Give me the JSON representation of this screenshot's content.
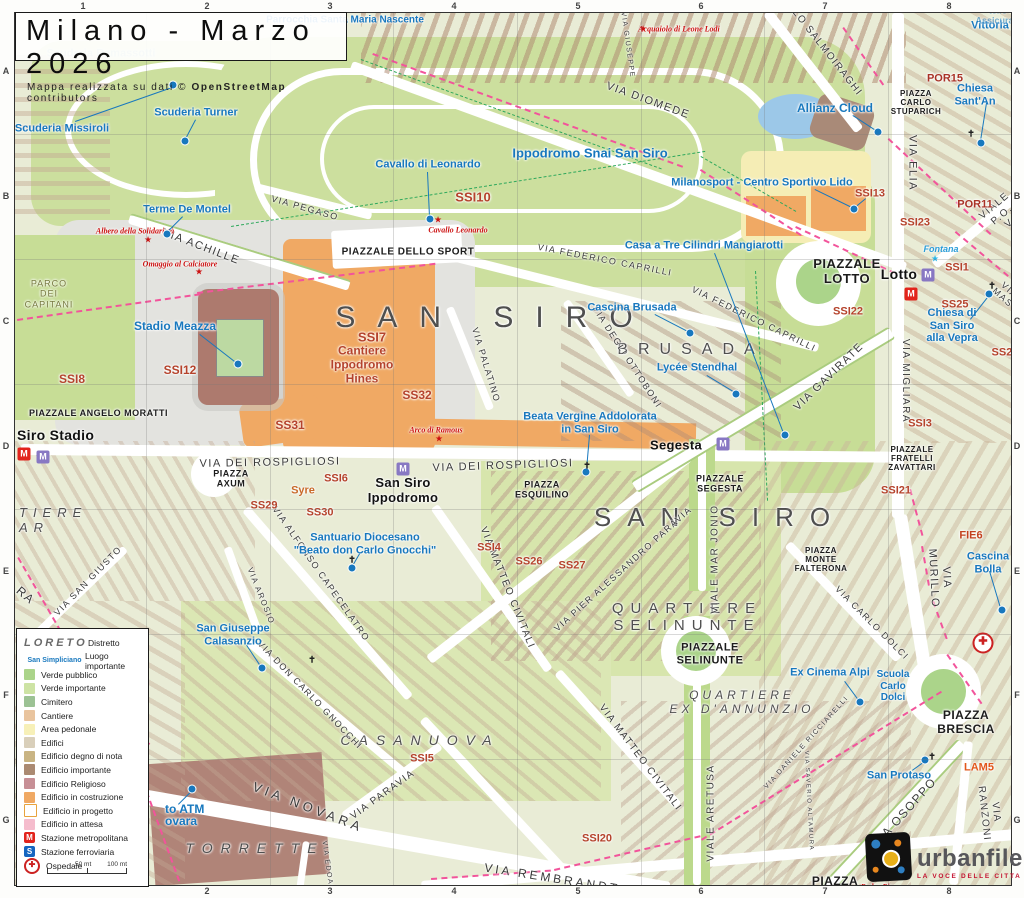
{
  "title": {
    "text": "Milano - Marzo 2026",
    "subtitle_prefix": "Mappa realizzata su dati © ",
    "subtitle_bold": "OpenStreetMap",
    "subtitle_suffix": " contributors"
  },
  "grid": {
    "cols": [
      "1",
      "2",
      "3",
      "4",
      "5",
      "6",
      "7",
      "8"
    ],
    "rows": [
      "A",
      "B",
      "C",
      "D",
      "E",
      "F",
      "G"
    ],
    "col_x": [
      83,
      207,
      330,
      454,
      578,
      701,
      825,
      949
    ],
    "row_y": [
      71,
      196,
      321,
      446,
      571,
      695,
      820
    ],
    "vlines_x": [
      145,
      269,
      392,
      516,
      640,
      763,
      887
    ],
    "hlines_y": [
      133,
      258,
      383,
      508,
      633,
      758
    ]
  },
  "legend": {
    "district_sample": "LORETO",
    "district_label": "Distretto",
    "place_sample": "San Simpliciano",
    "place_label": "Luogo importante",
    "items": [
      {
        "label": "Verde pubblico",
        "color": "#abd48a"
      },
      {
        "label": "Verde importante",
        "color": "#cde3a4"
      },
      {
        "label": "Cimitero",
        "color": "#9cc294"
      },
      {
        "label": "Cantiere",
        "color": "#e9c49e"
      },
      {
        "label": "Area pedonale",
        "color": "#f7f0b8"
      },
      {
        "label": "Edifici",
        "color": "#d9cfba"
      },
      {
        "label": "Edificio degno di nota",
        "color": "#c9b483"
      },
      {
        "label": "Edificio importante",
        "color": "#ab8a72"
      },
      {
        "label": "Edificio Religioso",
        "color": "#c78f96"
      },
      {
        "label": "Edificio in costruzione",
        "color": "#f0a964"
      },
      {
        "label": "Edificio in progetto",
        "color": "#ffffff",
        "border": "#e8a33d"
      },
      {
        "label": "Edificio in attesa",
        "color": "#f5bccd"
      }
    ],
    "stations": [
      {
        "icon": "M",
        "color": "#e2241c",
        "label": "Stazione metropolitana"
      },
      {
        "icon": "S",
        "color": "#1565c0",
        "label": "Stazione ferroviaria"
      }
    ],
    "hospital_label": "Ospedale",
    "scale": {
      "t1": "50 mt",
      "t2": "100 mt"
    }
  },
  "logo": {
    "name": "urbanfile",
    "tagline": "LA VOCE DELLE CITTA"
  },
  "labels": {
    "districts": [
      {
        "t": "SAN SIRO",
        "x": 480,
        "y": 305,
        "fs": 30,
        "ls": 22
      },
      {
        "t": "SAN SIRO",
        "x": 705,
        "y": 505,
        "fs": 26,
        "ls": 16
      },
      {
        "t": "BRUSADA",
        "x": 676,
        "y": 337,
        "fs": 16,
        "ls": 10
      },
      {
        "t": "CASANUOVA",
        "x": 405,
        "y": 727,
        "fs": 14,
        "ls": 8,
        "it": 1
      },
      {
        "t": "TORRETTE",
        "x": 240,
        "y": 835,
        "fs": 14,
        "ls": 8,
        "it": 1
      },
      {
        "t": "QUARTIERE\nSELINUNTE",
        "x": 672,
        "y": 604,
        "fs": 15,
        "ls": 7
      },
      {
        "t": "QUARTIERE\nEX D'ANNUNZIO",
        "x": 727,
        "y": 690,
        "fs": 12,
        "ls": 4,
        "it": 1
      },
      {
        "t": "TIERE\nAR",
        "x": 4,
        "y": 508,
        "fs": 13,
        "ls": 6,
        "it": 1,
        "al": "l"
      },
      {
        "t": "PARCO\nDEI\nCAPITANI",
        "x": 34,
        "y": 281,
        "fs": 9,
        "ls": 1,
        "c": "#76793f"
      }
    ],
    "squares": [
      {
        "t": "PIAZZALE DELLO SPORT",
        "x": 393,
        "y": 239,
        "fs": 10
      },
      {
        "t": "PIAZZA\nCARLO\nSTUPARICH",
        "x": 901,
        "y": 90,
        "fs": 8
      },
      {
        "t": "PIAZZALE\nLOTTO",
        "x": 832,
        "y": 259,
        "fs": 13
      },
      {
        "t": "PIAZZALE ANGELO MORATTI",
        "x": 14,
        "y": 400,
        "fs": 9,
        "al": "l"
      },
      {
        "t": "PIAZZA\nAXUM",
        "x": 216,
        "y": 466,
        "fs": 9
      },
      {
        "t": "PIAZZA\nESQUILINO",
        "x": 527,
        "y": 477,
        "fs": 9
      },
      {
        "t": "PIAZZALE\nSEGESTA",
        "x": 705,
        "y": 471,
        "fs": 9
      },
      {
        "t": "PIAZZA\nMONTE\nFALTERONA",
        "x": 806,
        "y": 547,
        "fs": 8
      },
      {
        "t": "PIAZZALE\nSELINUNTE",
        "x": 695,
        "y": 641,
        "fs": 11
      },
      {
        "t": "PIAZZALE\nFRATELLI\nZAVATTARI",
        "x": 897,
        "y": 446,
        "fs": 8
      },
      {
        "t": "PIAZZA\nBRESCIA",
        "x": 951,
        "y": 710,
        "fs": 12
      },
      {
        "t": "PIAZZA\nVELASQUEZ",
        "x": 820,
        "y": 876,
        "fs": 12
      }
    ],
    "roads": [
      {
        "t": "VIA DIOMEDE",
        "x": 633,
        "y": 88,
        "r": 20,
        "fs": 11
      },
      {
        "t": "VIA GIUSEPPE",
        "x": 612,
        "y": 32,
        "r": 82,
        "fs": 7
      },
      {
        "t": "LO SALMOIRAGHI",
        "x": 812,
        "y": 40,
        "r": 52,
        "fs": 10
      },
      {
        "t": "VIA ELIA",
        "x": 897,
        "y": 150,
        "r": 90,
        "fs": 11
      },
      {
        "t": "VIA PEGASO",
        "x": 290,
        "y": 195,
        "r": 16,
        "fs": 9
      },
      {
        "t": "VIA ACHILLE",
        "x": 186,
        "y": 234,
        "r": 21,
        "fs": 11
      },
      {
        "t": "VIA FEDERICO CAPRILLI",
        "x": 590,
        "y": 247,
        "r": 11,
        "fs": 9
      },
      {
        "t": "VIA FEDERICO CAPRILLI",
        "x": 739,
        "y": 306,
        "r": 26,
        "fs": 9
      },
      {
        "t": "VIA DEGLI OTTOBONI",
        "x": 612,
        "y": 344,
        "r": 57,
        "fs": 9
      },
      {
        "t": "VIA GAVIRATE",
        "x": 814,
        "y": 364,
        "r": -44,
        "fs": 11
      },
      {
        "t": "VIA MIGLIARA",
        "x": 890,
        "y": 368,
        "r": 90,
        "fs": 10
      },
      {
        "t": "VIALE P.O. V",
        "x": 987,
        "y": 202,
        "r": -40,
        "fs": 10
      },
      {
        "t": "VIA MAS",
        "x": 991,
        "y": 281,
        "r": 42,
        "fs": 9
      },
      {
        "t": "VIA DEI ROSPIGLIOSI",
        "x": 255,
        "y": 450,
        "r": -1,
        "fs": 11
      },
      {
        "t": "VIA DEI ROSPIGLIOSI",
        "x": 488,
        "y": 453,
        "r": -2,
        "fs": 11
      },
      {
        "t": "VIA PALATINO",
        "x": 471,
        "y": 352,
        "r": 73,
        "fs": 9
      },
      {
        "t": "VIA ALFONSO CAPECELATRO",
        "x": 306,
        "y": 561,
        "r": 55,
        "fs": 9
      },
      {
        "t": "VIA AROSIO",
        "x": 246,
        "y": 583,
        "r": 68,
        "fs": 8
      },
      {
        "t": "VIA MATTEO CIVITALI",
        "x": 492,
        "y": 575,
        "r": 68,
        "fs": 10
      },
      {
        "t": "VIA MATTEO CIVITALI",
        "x": 625,
        "y": 745,
        "r": 53,
        "fs": 10
      },
      {
        "t": "VIA PIER ALESSANDRO PARAVIA",
        "x": 608,
        "y": 556,
        "r": -42,
        "fs": 9
      },
      {
        "t": "VIALE MAR JONIO",
        "x": 700,
        "y": 546,
        "r": -90,
        "fs": 10
      },
      {
        "t": "VIA CARLO DOLCI",
        "x": 857,
        "y": 610,
        "r": 45,
        "fs": 9
      },
      {
        "t": "VIA MURILLO",
        "x": 925,
        "y": 565,
        "r": 87,
        "fs": 11
      },
      {
        "t": "VIA DANIELE RICCIARELLI",
        "x": 792,
        "y": 730,
        "r": -48,
        "fs": 7
      },
      {
        "t": "VIA SAN GIUSTO",
        "x": 73,
        "y": 568,
        "r": -46,
        "fs": 9
      },
      {
        "t": "VIA DON CARLO GNOCCHI",
        "x": 295,
        "y": 682,
        "r": 46,
        "fs": 9
      },
      {
        "t": "VIA NOVARA",
        "x": 293,
        "y": 795,
        "r": 21,
        "fs": 13,
        "ls": 4
      },
      {
        "t": "VIA PARAVIA",
        "x": 368,
        "y": 782,
        "r": -36,
        "fs": 10
      },
      {
        "t": "VIA EDOARDO",
        "x": 313,
        "y": 860,
        "r": 82,
        "fs": 7
      },
      {
        "t": "VIA REMBRANDT",
        "x": 537,
        "y": 866,
        "r": 9,
        "fs": 12,
        "ls": 3
      },
      {
        "t": "VIA REMBRANDT",
        "x": 745,
        "y": 884,
        "r": 0,
        "fs": 8
      },
      {
        "t": "VIALE ARETUSA",
        "x": 696,
        "y": 800,
        "r": -90,
        "fs": 10
      },
      {
        "t": "VIA OSOPPO",
        "x": 890,
        "y": 800,
        "r": -48,
        "fs": 12
      },
      {
        "t": "VIA RANZONI",
        "x": 975,
        "y": 800,
        "r": 84,
        "fs": 10
      },
      {
        "t": "VIA SAVERIO ALTAMURA",
        "x": 793,
        "y": 788,
        "r": 87,
        "fs": 6
      },
      {
        "t": "VIA RUBE",
        "x": 995,
        "y": 887,
        "r": 12,
        "fs": 9
      },
      {
        "t": "RA",
        "x": 10,
        "y": 583,
        "r": 40,
        "fs": 12
      }
    ],
    "pois": [
      {
        "t": "Scuderia Missiroli",
        "x": 47,
        "y": 116
      },
      {
        "t": "Scuderia Turner",
        "x": 181,
        "y": 100
      },
      {
        "t": "Scuderia Ramassotti",
        "x": 86,
        "y": 41,
        "o": 0.35
      },
      {
        "t": "Parrocchia Santa Maria Nascente",
        "x": 330,
        "y": 7,
        "fs": 10
      },
      {
        "t": "Terme De Montel",
        "x": 172,
        "y": 197
      },
      {
        "t": "Cavallo di Leonardo",
        "x": 413,
        "y": 152
      },
      {
        "t": "Ippodromo Snai San Siro",
        "x": 575,
        "y": 141,
        "fs": 13
      },
      {
        "t": "Allianz Cloud",
        "x": 820,
        "y": 96,
        "fs": 12
      },
      {
        "t": "Milanosport - Centro Sportivo Lido",
        "x": 747,
        "y": 170
      },
      {
        "t": "Casa a Tre Cilindri Mangiarotti",
        "x": 689,
        "y": 233
      },
      {
        "t": "Cascina Brusada",
        "x": 617,
        "y": 295
      },
      {
        "t": "Lycée Stendhal",
        "x": 682,
        "y": 355
      },
      {
        "t": "Chiesa Sant'An",
        "x": 960,
        "y": 82
      },
      {
        "t": "Vittoria",
        "x": 975,
        "y": 13
      },
      {
        "t": "tello Assicurazi",
        "x": 983,
        "y": 3,
        "fs": 9,
        "o": 0.55
      },
      {
        "t": "Fontana",
        "x": 926,
        "y": 236,
        "fs": 9,
        "it": 1,
        "c": "#2a9dd8"
      },
      {
        "t": "Chiesa di San Siro alla Vepra",
        "x": 937,
        "y": 313
      },
      {
        "t": "Beata Vergine Addolorata\nin San Siro",
        "x": 575,
        "y": 410
      },
      {
        "t": "Stadio Meazza",
        "x": 160,
        "y": 314,
        "fs": 12
      },
      {
        "t": "Santuario Diocesano\n\"Beato don Carlo Gnocchi\"",
        "x": 350,
        "y": 531
      },
      {
        "t": "San Giuseppe\nCalasanzio",
        "x": 218,
        "y": 622
      },
      {
        "t": "Ex Cinema Alpi",
        "x": 815,
        "y": 660
      },
      {
        "t": "Scuola\nCarlo\nDolci",
        "x": 878,
        "y": 673,
        "fs": 10
      },
      {
        "t": "Cascina Bolla",
        "x": 973,
        "y": 550
      },
      {
        "t": "San Protaso",
        "x": 884,
        "y": 763
      },
      {
        "t": "to ATM",
        "x": 150,
        "y": 797,
        "fs": 12,
        "al": "l"
      },
      {
        "t": "ovara",
        "x": 150,
        "y": 809,
        "fs": 12,
        "al": "l"
      }
    ],
    "codes": [
      {
        "t": "SSI10",
        "x": 458,
        "y": 185,
        "fs": 13
      },
      {
        "t": "SSI7",
        "x": 357,
        "y": 325,
        "fs": 13
      },
      {
        "t": "Cantiere\nIppodromo\nHines",
        "x": 347,
        "y": 352,
        "fs": 12
      },
      {
        "t": "SS32",
        "x": 402,
        "y": 383,
        "fs": 12
      },
      {
        "t": "SS31",
        "x": 275,
        "y": 413,
        "fs": 12
      },
      {
        "t": "SSI8",
        "x": 57,
        "y": 367,
        "fs": 12
      },
      {
        "t": "SSI12",
        "x": 165,
        "y": 358,
        "fs": 12
      },
      {
        "t": "SSI6",
        "x": 321,
        "y": 466
      },
      {
        "t": "SS29",
        "x": 249,
        "y": 493
      },
      {
        "t": "SS30",
        "x": 305,
        "y": 500
      },
      {
        "t": "Syre",
        "x": 288,
        "y": 478,
        "c": "#c96a2a"
      },
      {
        "t": "SSI4",
        "x": 474,
        "y": 535
      },
      {
        "t": "SS26",
        "x": 514,
        "y": 549
      },
      {
        "t": "SS27",
        "x": 557,
        "y": 553
      },
      {
        "t": "SSI13",
        "x": 855,
        "y": 181
      },
      {
        "t": "SSI23",
        "x": 900,
        "y": 210
      },
      {
        "t": "SSI22",
        "x": 833,
        "y": 299
      },
      {
        "t": "SSI1",
        "x": 942,
        "y": 255
      },
      {
        "t": "SS25",
        "x": 940,
        "y": 292
      },
      {
        "t": "SS28",
        "x": 990,
        "y": 340
      },
      {
        "t": "SSI3",
        "x": 905,
        "y": 411
      },
      {
        "t": "SSI21",
        "x": 881,
        "y": 478
      },
      {
        "t": "POR15",
        "x": 930,
        "y": 66,
        "c": "#a93226"
      },
      {
        "t": "POR11",
        "x": 960,
        "y": 192,
        "c": "#a93226"
      },
      {
        "t": "PO",
        "x": 1006,
        "y": 208,
        "c": "#d4551f"
      },
      {
        "t": "FIE6",
        "x": 956,
        "y": 523,
        "c": "#c3411f"
      },
      {
        "t": "LAM5",
        "x": 964,
        "y": 755,
        "c": "#e2571b"
      },
      {
        "t": "LAM2",
        "x": 649,
        "y": 888,
        "c": "#f291a6"
      },
      {
        "t": "SSI5",
        "x": 407,
        "y": 746
      },
      {
        "t": "SSI20",
        "x": 582,
        "y": 826
      }
    ],
    "monuments": [
      {
        "t": "Albero della Solidarietà",
        "x": 120,
        "y": 218
      },
      {
        "t": "Omaggio al Calciatore",
        "x": 165,
        "y": 251
      },
      {
        "t": "Cavallo Leonardo",
        "x": 443,
        "y": 217
      },
      {
        "t": "Arco di Ramous",
        "x": 421,
        "y": 417
      },
      {
        "t": "Acquaiolo di Leone Lodi",
        "x": 664,
        "y": 16
      },
      {
        "t": "Padre Pio",
        "x": 862,
        "y": 874
      }
    ],
    "stations_text": [
      {
        "t": "Siro Stadio",
        "x": 2,
        "y": 422,
        "fs": 14,
        "al": "l"
      },
      {
        "t": "San Siro\nIppodromo",
        "x": 388,
        "y": 478
      },
      {
        "t": "Segesta",
        "x": 661,
        "y": 433
      },
      {
        "t": "Lotto",
        "x": 884,
        "y": 261,
        "fs": 14
      }
    ]
  },
  "markers": {
    "dots": [
      {
        "x": 158,
        "y": 72
      },
      {
        "x": 170,
        "y": 128
      },
      {
        "x": 152,
        "y": 221
      },
      {
        "x": 415,
        "y": 206
      },
      {
        "x": 863,
        "y": 119
      },
      {
        "x": 839,
        "y": 196
      },
      {
        "x": 770,
        "y": 422
      },
      {
        "x": 675,
        "y": 320
      },
      {
        "x": 721,
        "y": 381
      },
      {
        "x": 966,
        "y": 130
      },
      {
        "x": 974,
        "y": 281
      },
      {
        "x": 571,
        "y": 459
      },
      {
        "x": 223,
        "y": 351
      },
      {
        "x": 337,
        "y": 555
      },
      {
        "x": 247,
        "y": 655
      },
      {
        "x": 845,
        "y": 689
      },
      {
        "x": 987,
        "y": 597
      },
      {
        "x": 910,
        "y": 747
      },
      {
        "x": 177,
        "y": 776
      }
    ],
    "lines": [
      {
        "x1": 60,
        "y1": 108,
        "x2": 157,
        "y2": 74
      },
      {
        "x1": 181,
        "y1": 107,
        "x2": 171,
        "y2": 126
      },
      {
        "x1": 168,
        "y1": 204,
        "x2": 153,
        "y2": 219
      },
      {
        "x1": 413,
        "y1": 159,
        "x2": 415,
        "y2": 204
      },
      {
        "x1": 838,
        "y1": 102,
        "x2": 861,
        "y2": 117
      },
      {
        "x1": 800,
        "y1": 176,
        "x2": 837,
        "y2": 194
      },
      {
        "x1": 851,
        "y1": 186,
        "x2": 840,
        "y2": 195
      },
      {
        "x1": 700,
        "y1": 240,
        "x2": 769,
        "y2": 420
      },
      {
        "x1": 640,
        "y1": 301,
        "x2": 673,
        "y2": 318
      },
      {
        "x1": 692,
        "y1": 362,
        "x2": 720,
        "y2": 379
      },
      {
        "x1": 972,
        "y1": 90,
        "x2": 966,
        "y2": 128
      },
      {
        "x1": 955,
        "y1": 306,
        "x2": 973,
        "y2": 283
      },
      {
        "x1": 575,
        "y1": 422,
        "x2": 572,
        "y2": 457
      },
      {
        "x1": 185,
        "y1": 321,
        "x2": 221,
        "y2": 349
      },
      {
        "x1": 345,
        "y1": 541,
        "x2": 338,
        "y2": 553
      },
      {
        "x1": 232,
        "y1": 632,
        "x2": 246,
        "y2": 653
      },
      {
        "x1": 830,
        "y1": 668,
        "x2": 844,
        "y2": 687
      },
      {
        "x1": 975,
        "y1": 558,
        "x2": 986,
        "y2": 595
      },
      {
        "x1": 897,
        "y1": 757,
        "x2": 908,
        "y2": 749
      },
      {
        "x1": 163,
        "y1": 791,
        "x2": 176,
        "y2": 778
      }
    ],
    "stars": [
      {
        "x": 133,
        "y": 227,
        "c": "#cc1111"
      },
      {
        "x": 184,
        "y": 259,
        "c": "#cc1111"
      },
      {
        "x": 423,
        "y": 207,
        "c": "#cc1111"
      },
      {
        "x": 424,
        "y": 426,
        "c": "#cc1111"
      },
      {
        "x": 628,
        "y": 16,
        "c": "#cc1111"
      },
      {
        "x": 845,
        "y": 875,
        "c": "#cc1111"
      },
      {
        "x": 920,
        "y": 246,
        "c": "#29b6e8"
      }
    ],
    "metro": [
      {
        "x": 9,
        "y": 441,
        "type": "red"
      },
      {
        "x": 28,
        "y": 444,
        "type": "purple"
      },
      {
        "x": 388,
        "y": 456,
        "type": "purple"
      },
      {
        "x": 708,
        "y": 431,
        "type": "purple"
      },
      {
        "x": 913,
        "y": 262,
        "type": "purple"
      },
      {
        "x": 896,
        "y": 281,
        "type": "red"
      }
    ],
    "hospital": {
      "x": 968,
      "y": 630
    },
    "crosses": [
      {
        "x": 572,
        "y": 453
      },
      {
        "x": 956,
        "y": 121
      },
      {
        "x": 977,
        "y": 273
      },
      {
        "x": 297,
        "y": 647
      },
      {
        "x": 917,
        "y": 744
      },
      {
        "x": 337,
        "y": 547
      }
    ]
  }
}
